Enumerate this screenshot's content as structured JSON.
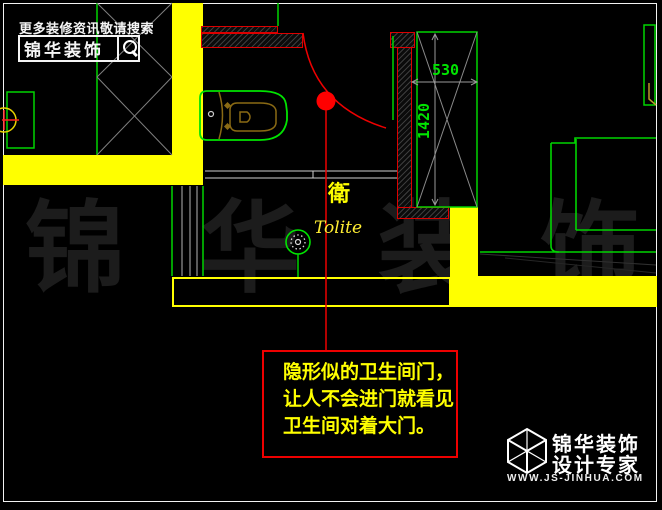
{
  "promo": {
    "tagline": "更多装修资讯敬请搜索",
    "brand": "锦华装饰"
  },
  "plan": {
    "room_label_cn": "衛",
    "room_label_en": "Tolite",
    "dim_top": "530",
    "dim_side": "1420"
  },
  "annotation": {
    "line1": "隐形似的卫生间门，",
    "line2": "让人不会进门就看见",
    "line3": "卫生间对着大门。"
  },
  "watermark": {
    "char1": "锦",
    "char2": "华",
    "char3": "装",
    "char4": "饰"
  },
  "footer": {
    "brand": "锦华装饰",
    "tagline": "设计专家",
    "website": "WWW.JS-JINHUA.COM"
  },
  "colors": {
    "background": "#000000",
    "wall_fill_yellow": "#ffff00",
    "wall_border_red": "#dd0000",
    "fixture_green": "#00e400",
    "marker_red": "#ff0000",
    "dim_gray": "#9a9a9a",
    "watermark_gray": "#1c1c1c",
    "label_yellow": "#ffff00",
    "fixture_detail_olive": "#8a6a14",
    "frame_white": "#f2f2f2"
  }
}
